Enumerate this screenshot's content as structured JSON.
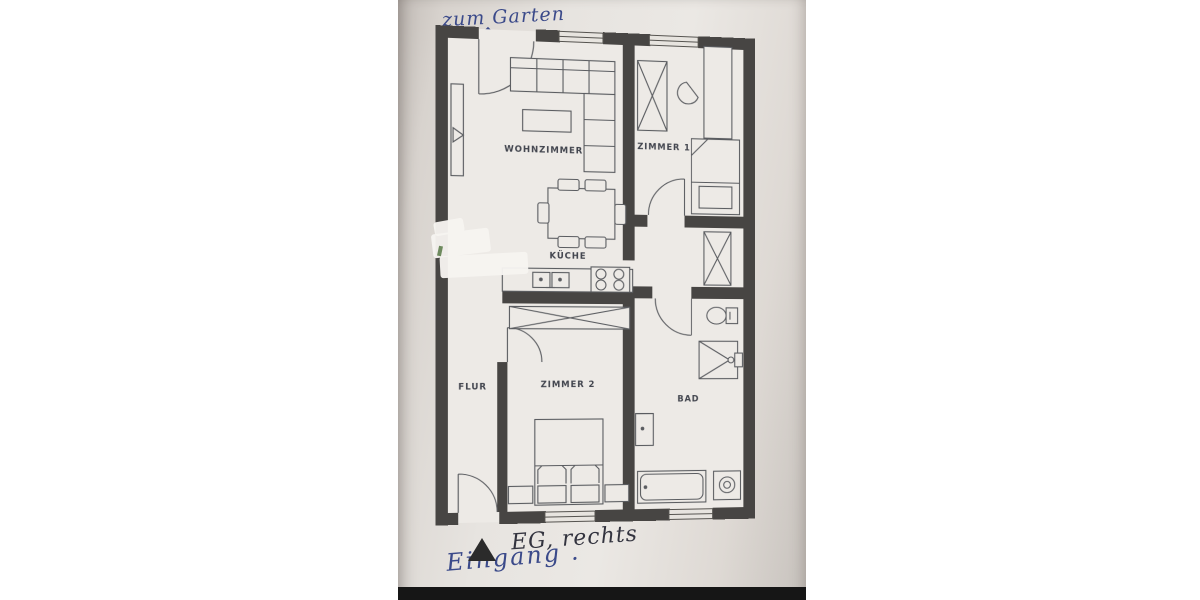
{
  "annotations": {
    "zum_garten": "zum Garten",
    "arrow_up": "↑",
    "eg_rechts": "EG, rechts",
    "eingang": "Eingang ."
  },
  "rooms": {
    "wohnzimmer": "WOHNZIMMER",
    "zimmer1": "ZIMMER 1",
    "kueche": "KÜCHE",
    "flur": "FLUR",
    "zimmer2": "ZIMMER 2",
    "bad": "BAD"
  },
  "floorplan": {
    "type": "apartment-floor-plan",
    "floor_note": "EG, rechts",
    "garden_access": "terrace door at top wall, marked 'zum Garten'",
    "entrance": "door in bottom wall at Flur, marked with triangle and 'Eingang'",
    "furniture": {
      "wohnzimmer": [
        "corner-sofa",
        "coffee-table",
        "wall-shelf",
        "dining-table",
        "six-chairs"
      ],
      "kueche": [
        "kitchen-counter",
        "double-sink",
        "stove-4-burners"
      ],
      "zimmer1": [
        "wardrobe",
        "desk",
        "chair",
        "single-bed"
      ],
      "corridor": [
        "wardrobe"
      ],
      "zimmer2": [
        "wardrobe",
        "double-bed",
        "nightstand-left",
        "nightstand-right"
      ],
      "bad": [
        "toilet",
        "shower",
        "wash-basin",
        "bathtub",
        "washing-machine"
      ]
    }
  },
  "colors": {
    "wall": "#474543",
    "paper": "#e9e6e2",
    "plan_interior": "#edeae6",
    "furniture_line": "#5a5c60",
    "ink_blue": "#3b4a8a",
    "ink_dark": "#33343f",
    "photo_bottom_band": "#161616"
  }
}
